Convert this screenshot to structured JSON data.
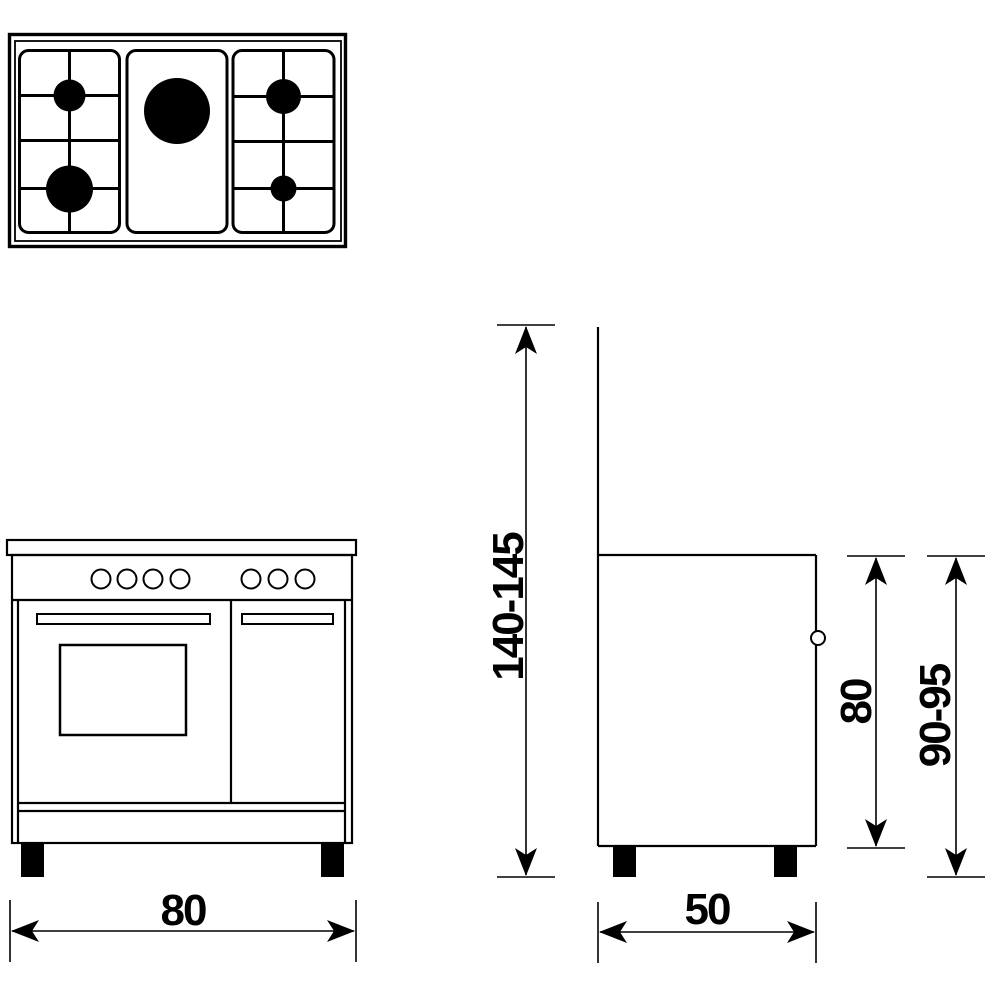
{
  "colors": {
    "line": "#000000",
    "background": "#ffffff",
    "burner_fill": "#000000",
    "foot_fill": "#000000"
  },
  "top_view": {
    "burner_count": 5,
    "pan_supports": 3
  },
  "front_view": {
    "knob_count": 7,
    "door_count": 2
  },
  "dimensions": {
    "total_height": {
      "label": "140-145"
    },
    "body_height": {
      "label": "80"
    },
    "working_height": {
      "label": "90-95"
    },
    "width": {
      "label": "80"
    },
    "depth": {
      "label": "50"
    }
  }
}
